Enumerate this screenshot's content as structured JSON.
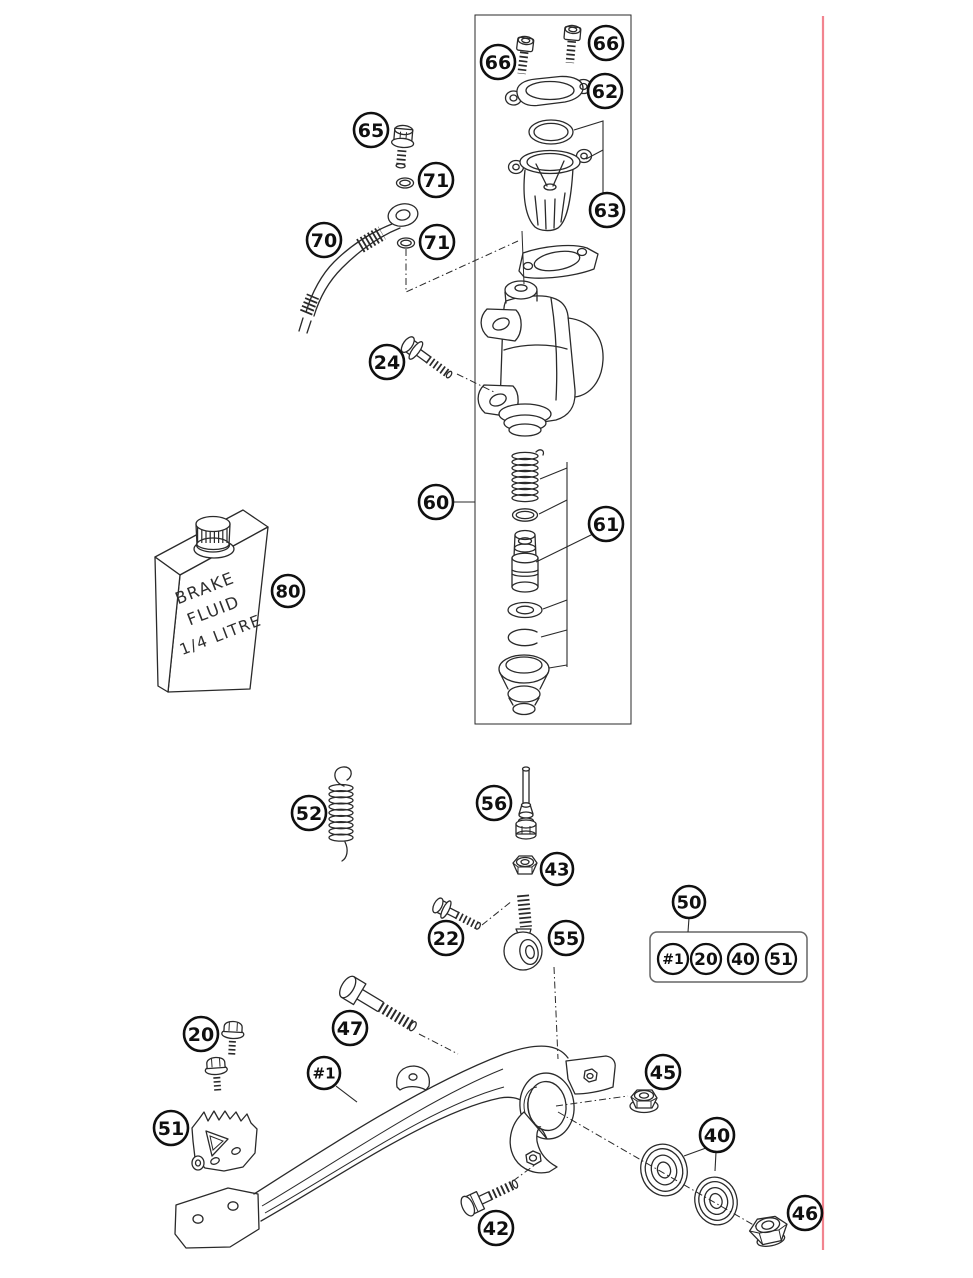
{
  "figure": {
    "type": "exploded-parts-diagram",
    "subject": "rear brake control with master cylinder",
    "background": "#ffffff",
    "ink_color": "#2a2a2a",
    "red_rule_color": "#f2848f"
  },
  "bottle": {
    "line1": "BRAKE",
    "line2": "FLUID",
    "line3": "1/4 LITRE"
  },
  "callouts": [
    {
      "id": "66-left",
      "label": "66",
      "x": 498,
      "y": 62,
      "r": 17
    },
    {
      "id": "66-right",
      "label": "66",
      "x": 606,
      "y": 43,
      "r": 17
    },
    {
      "id": "62",
      "label": "62",
      "x": 605,
      "y": 91,
      "r": 17
    },
    {
      "id": "63",
      "label": "63",
      "x": 607,
      "y": 210,
      "r": 17
    },
    {
      "id": "65",
      "label": "65",
      "x": 371,
      "y": 130,
      "r": 17
    },
    {
      "id": "71-upper",
      "label": "71",
      "x": 436,
      "y": 180,
      "r": 17
    },
    {
      "id": "70",
      "label": "70",
      "x": 324,
      "y": 240,
      "r": 17
    },
    {
      "id": "71-lower",
      "label": "71",
      "x": 437,
      "y": 242,
      "r": 17
    },
    {
      "id": "24",
      "label": "24",
      "x": 387,
      "y": 362,
      "r": 17
    },
    {
      "id": "60",
      "label": "60",
      "x": 436,
      "y": 502,
      "r": 17
    },
    {
      "id": "61",
      "label": "61",
      "x": 606,
      "y": 524,
      "r": 17
    },
    {
      "id": "80",
      "label": "80",
      "x": 288,
      "y": 591,
      "r": 16
    },
    {
      "id": "52",
      "label": "52",
      "x": 309,
      "y": 813,
      "r": 17
    },
    {
      "id": "56",
      "label": "56",
      "x": 494,
      "y": 803,
      "r": 17
    },
    {
      "id": "43",
      "label": "43",
      "x": 557,
      "y": 869,
      "r": 16
    },
    {
      "id": "22",
      "label": "22",
      "x": 446,
      "y": 938,
      "r": 17
    },
    {
      "id": "55",
      "label": "55",
      "x": 566,
      "y": 938,
      "r": 17
    },
    {
      "id": "50",
      "label": "50",
      "x": 689,
      "y": 902,
      "r": 16
    },
    {
      "id": "kit-1",
      "label": "#1",
      "x": 673,
      "y": 959,
      "r": 15
    },
    {
      "id": "kit-20",
      "label": "20",
      "x": 706,
      "y": 959,
      "r": 15
    },
    {
      "id": "kit-40",
      "label": "40",
      "x": 743,
      "y": 959,
      "r": 15
    },
    {
      "id": "kit-51",
      "label": "51",
      "x": 781,
      "y": 959,
      "r": 15
    },
    {
      "id": "20",
      "label": "20",
      "x": 201,
      "y": 1034,
      "r": 17
    },
    {
      "id": "47",
      "label": "47",
      "x": 350,
      "y": 1028,
      "r": 17
    },
    {
      "id": "hash1",
      "label": "#1",
      "x": 324,
      "y": 1073,
      "r": 16
    },
    {
      "id": "51",
      "label": "51",
      "x": 171,
      "y": 1128,
      "r": 17
    },
    {
      "id": "45",
      "label": "45",
      "x": 663,
      "y": 1072,
      "r": 17
    },
    {
      "id": "40",
      "label": "40",
      "x": 717,
      "y": 1135,
      "r": 17
    },
    {
      "id": "42",
      "label": "42",
      "x": 496,
      "y": 1228,
      "r": 17
    },
    {
      "id": "46",
      "label": "46",
      "x": 805,
      "y": 1213,
      "r": 17
    }
  ]
}
